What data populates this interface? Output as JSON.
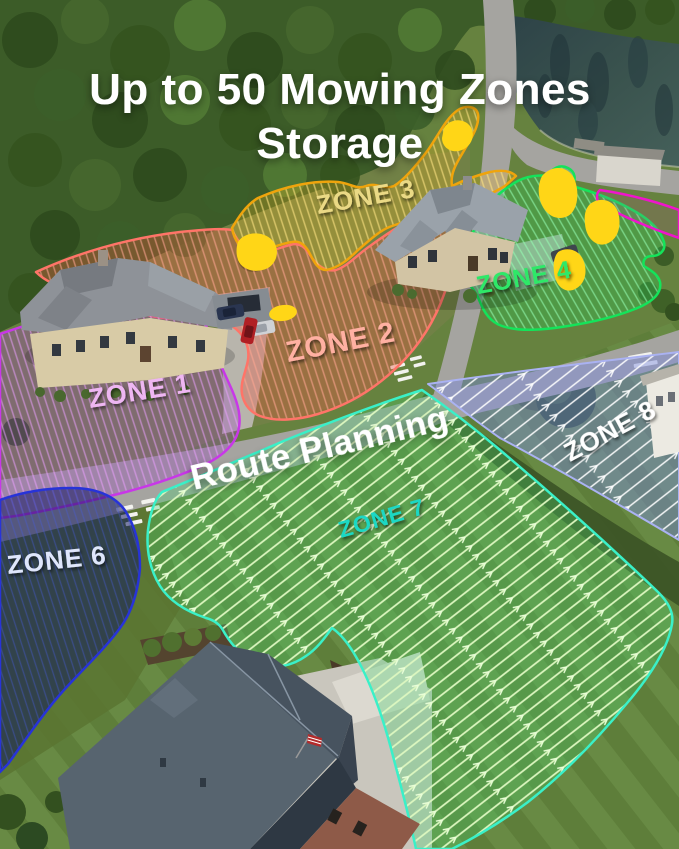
{
  "title": {
    "line1": "Up to 50 Mowing Zones",
    "line2": "Storage"
  },
  "route_planning_label": "Route Planning",
  "zones": [
    {
      "label": "ZONE 1",
      "outline": "#c837e8",
      "label_color": "#eeb6f2"
    },
    {
      "label": "ZONE 2",
      "outline": "#ff7468",
      "label_color": "#ffb0a2"
    },
    {
      "label": "ZONE 3",
      "outline": "#efa40c",
      "label_color": "#ead985"
    },
    {
      "label": "ZONE 4",
      "outline": "#14e35a",
      "label_color": "#2fe868"
    },
    {
      "label": "ZONE 6",
      "outline": "#2733d8",
      "label_color": "#dfe6fb"
    },
    {
      "label": "ZONE 7",
      "outline": "#3af0c8",
      "label_color": "#1ad8c4"
    },
    {
      "label": "ZONE 8",
      "outline": "#aab2f2",
      "label_color": "#ffffff"
    }
  ],
  "unlabeled_zone_outline": "#ef14cc",
  "obstacle_marker_color": "#ffd617"
}
